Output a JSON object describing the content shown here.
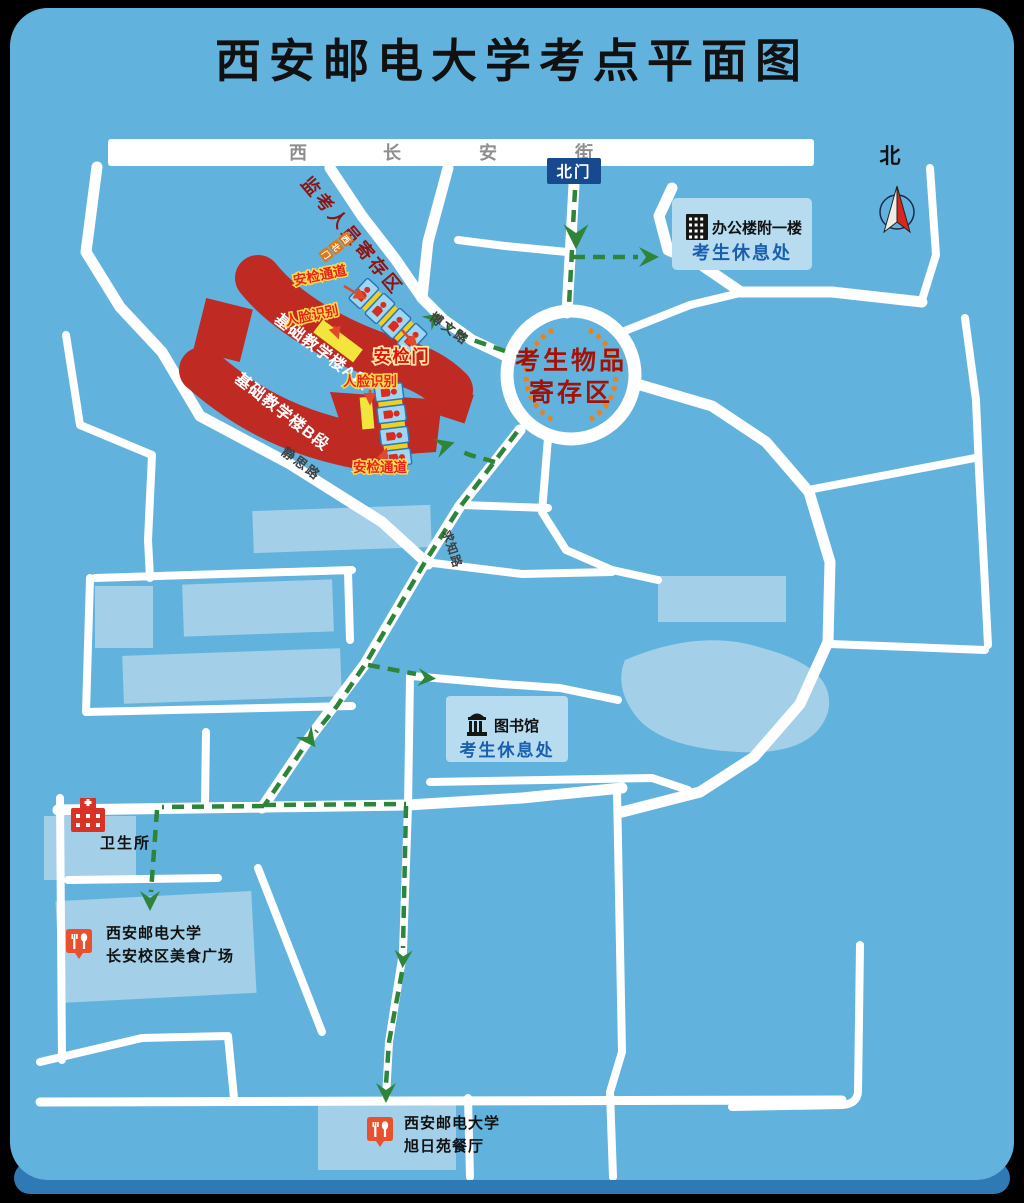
{
  "page": {
    "title": "西安邮电大学考点平面图"
  },
  "street": {
    "chars": [
      "西",
      "长",
      "安",
      "街"
    ]
  },
  "badges": {
    "north_gate": "北门",
    "northwest_gate_chars": [
      "西",
      "北",
      "门"
    ]
  },
  "compass": {
    "north": "北"
  },
  "rest_areas": {
    "office": {
      "name": "办公楼附一楼",
      "note": "考生休息处"
    },
    "library": {
      "name": "图书馆",
      "note": "考生休息处"
    }
  },
  "storage_circle": {
    "line1": "考生物品",
    "line2": "寄存区"
  },
  "security": {
    "invigilator_storage": "监考人员寄存区",
    "channel_upper": "安检通道",
    "face_upper": "人脸识别",
    "gate": "安检门",
    "face_lower": "人脸识别",
    "channel_lower": "安检通道"
  },
  "buildings": {
    "teaching_a": "基础教学楼A段",
    "teaching_b": "基础教学楼B段",
    "clinic": "卫生所",
    "food_plaza": {
      "line1": "西安邮电大学",
      "line2": "长安校区美食广场"
    },
    "canteen": {
      "line1": "西安邮电大学",
      "line2": "旭日苑餐厅"
    }
  },
  "roads": {
    "bowen": "博文路",
    "jingsi": "静思路",
    "qiuzhi": "求知路"
  },
  "colors": {
    "background": "#000000",
    "map_blue": "#62b2de",
    "map_lip_blue": "#2f79b5",
    "road_white": "#ffffff",
    "building_red": "#bf2a23",
    "building_pale": "#abd3e9",
    "route_green": "#2e8539",
    "accent_yellow": "#f2ce1f",
    "label_red": "#e8251a",
    "dark_red": "#a31208",
    "badge_blue": "#17498f",
    "rest_note_blue": "#1a5fae",
    "orange_tick": "#e8821e"
  }
}
